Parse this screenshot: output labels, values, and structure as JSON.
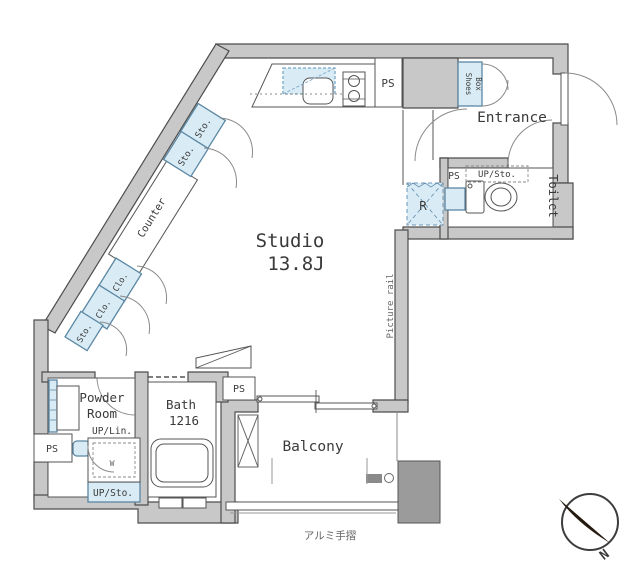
{
  "colors": {
    "wall_fill": "#c8c8c8",
    "wall_stroke": "#4d4d4d",
    "fixture_blue": "#d9ecf6",
    "fixture_blue_stroke": "#5b87a3",
    "text": "#3a3a3a",
    "outside_block": "#9b9b9b"
  },
  "floor_plan": {
    "rooms": {
      "studio": {
        "label": "Studio",
        "size": "13.8J"
      },
      "entrance": {
        "label": "Entrance"
      },
      "toilet": {
        "label": "Toilet"
      },
      "bath": {
        "label": "Bath",
        "size": "1216"
      },
      "powder_room": {
        "label_line1": "Powder",
        "label_line2": "Room"
      },
      "balcony": {
        "label": "Balcony"
      }
    },
    "fixtures": {
      "counter": "Counter",
      "ps": "PS",
      "sto": "Sto.",
      "clo": "Clo.",
      "shoes_box_line1": "Shoes",
      "shoes_box_line2": "Box",
      "up_sto": "UP/Sto.",
      "up_lin": "UP/Lin.",
      "refrigerator": "R",
      "washing_machine": "W",
      "picture_rail": "Picture rail",
      "handrail": "アルミ手摺"
    },
    "compass": {
      "north": "N"
    }
  }
}
